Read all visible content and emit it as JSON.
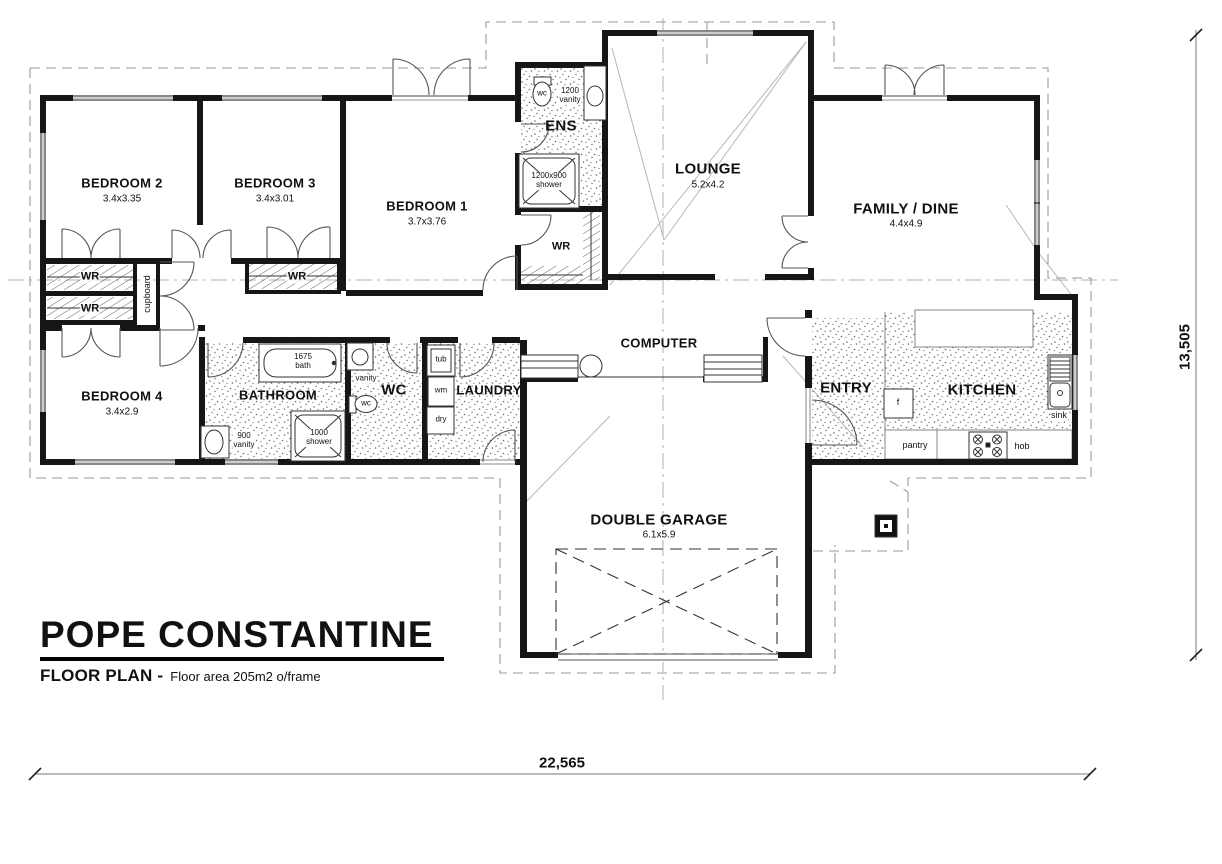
{
  "title_block": {
    "name": "POPE CONSTANTINE",
    "plan_label": "FLOOR PLAN -",
    "area_note": "Floor area 205m2 o/frame"
  },
  "dimensions": {
    "width_label": "22,565",
    "height_label": "13,505"
  },
  "rooms": {
    "bedroom2": {
      "name": "BEDROOM 2",
      "size": "3.4x3.35"
    },
    "bedroom3": {
      "name": "BEDROOM 3",
      "size": "3.4x3.01"
    },
    "bedroom1": {
      "name": "BEDROOM 1",
      "size": "3.7x3.76"
    },
    "bedroom4": {
      "name": "BEDROOM 4",
      "size": "3.4x2.9"
    },
    "ens": {
      "name": "ENS"
    },
    "lounge": {
      "name": "LOUNGE",
      "size": "5.2x4.2"
    },
    "family_dine": {
      "name": "FAMILY / DINE",
      "size": "4.4x4.9"
    },
    "bathroom": {
      "name": "BATHROOM"
    },
    "wc": {
      "name": "WC"
    },
    "laundry": {
      "name": "LAUNDRY"
    },
    "computer": {
      "name": "COMPUTER"
    },
    "entry": {
      "name": "ENTRY"
    },
    "kitchen": {
      "name": "KITCHEN"
    },
    "garage": {
      "name": "DOUBLE GARAGE",
      "size": "6.1x5.9"
    }
  },
  "storage": {
    "wardrobe": "WR",
    "cupboard": "cupboard"
  },
  "fixtures": {
    "wc_symbol": "wc",
    "ens_vanity": "1200\nvanity",
    "ens_shower": "1200x900\nshower",
    "bath": "1675\nbath",
    "bath_vanity": "900\nvanity",
    "bath_shower": "1000\nshower",
    "wc_vanity": "vanity",
    "tub": "tub",
    "washing_machine": "wm",
    "dryer": "dry",
    "fridge": "f",
    "pantry": "pantry",
    "hob": "hob",
    "sink": "sink"
  }
}
